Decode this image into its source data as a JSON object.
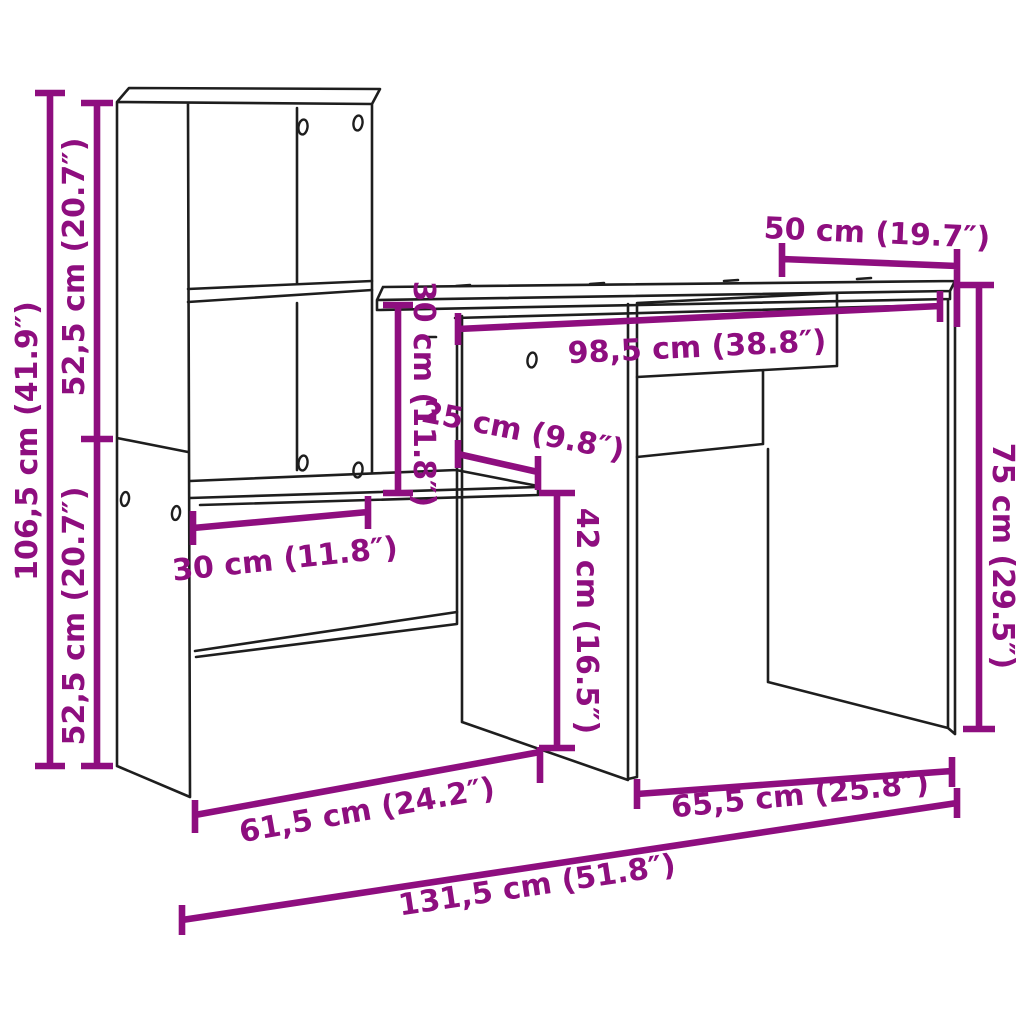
{
  "diagram": {
    "kind": "furniture-dimension-diagram",
    "subject": "desk-with-shelving-unit",
    "background": "#ffffff"
  },
  "colors": {
    "dimension": "#8E0E7F",
    "outline": "#1E1E1E"
  },
  "dimensions": {
    "total_height": "106,5 cm (41.9″)",
    "upper_section_height": "52,5 cm (20.7″)",
    "lower_section_height": "52,5 cm (20.7″)",
    "desk_depth": "50 cm (19.7″)",
    "desktop_width": "98,5 cm (38.8″)",
    "hutch_clearance_height": "30 cm (11.8″)",
    "shelf_depth": "25 cm (9.8″)",
    "shelf_width": "30 cm (11.8″)",
    "under_shelf_clearance": "42 cm (16.5″)",
    "desk_height": "75 cm (29.5″)",
    "left_section_width": "61,5 cm (24.2″)",
    "right_section_width": "65,5 cm (25.8″)",
    "total_width": "131,5 cm (51.8″)"
  }
}
